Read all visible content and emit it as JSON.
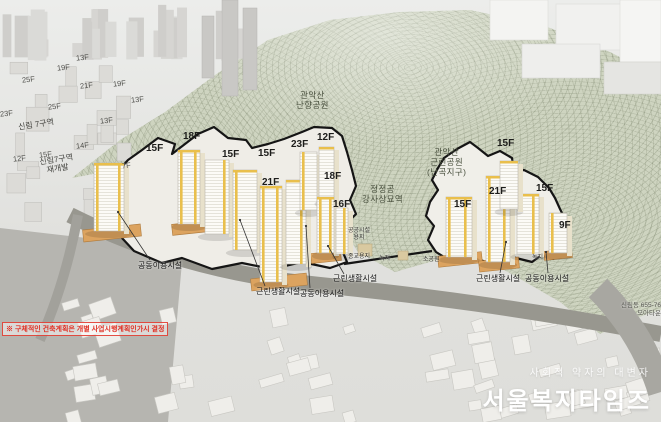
{
  "scene": {
    "disclaimer": "※ 구체적인 건축계획은 개별 사업시행계획인가시 결정",
    "watermark": {
      "slogan": "사회적 약자의 대변자",
      "title": "서울복지타임즈"
    },
    "address": {
      "line1": "신림동 655-76",
      "line2": "모아타운"
    }
  },
  "colors": {
    "accent_yellow": "#e9bf4c",
    "site_outline": "#151515",
    "mountain_green": "#ced4c0",
    "road_gray": "#98978f",
    "podium_orange": "#dca35f",
    "disclaimer_red": "#e03024"
  },
  "labels": {
    "site_floors": [
      {
        "t": "15F",
        "x": 146,
        "y": 143
      },
      {
        "t": "18F",
        "x": 183,
        "y": 131
      },
      {
        "t": "15F",
        "x": 222,
        "y": 149
      },
      {
        "t": "15F",
        "x": 258,
        "y": 148
      },
      {
        "t": "23F",
        "x": 291,
        "y": 139
      },
      {
        "t": "12F",
        "x": 317,
        "y": 132
      },
      {
        "t": "21F",
        "x": 262,
        "y": 177
      },
      {
        "t": "18F",
        "x": 324,
        "y": 171
      },
      {
        "t": "16F",
        "x": 333,
        "y": 199
      },
      {
        "t": "15F",
        "x": 497,
        "y": 138
      },
      {
        "t": "15F",
        "x": 536,
        "y": 183
      },
      {
        "t": "21F",
        "x": 489,
        "y": 186
      },
      {
        "t": "15F",
        "x": 454,
        "y": 199
      },
      {
        "t": "9F",
        "x": 559,
        "y": 220
      }
    ],
    "context_floors": [
      {
        "t": "13F",
        "x": 76,
        "y": 54
      },
      {
        "t": "19F",
        "x": 57,
        "y": 64
      },
      {
        "t": "25F",
        "x": 22,
        "y": 76
      },
      {
        "t": "21F",
        "x": 80,
        "y": 82
      },
      {
        "t": "19F",
        "x": 113,
        "y": 80
      },
      {
        "t": "13F",
        "x": 131,
        "y": 96
      },
      {
        "t": "25F",
        "x": 48,
        "y": 103
      },
      {
        "t": "13F",
        "x": 100,
        "y": 117
      },
      {
        "t": "23F",
        "x": 0,
        "y": 110
      },
      {
        "t": "12F",
        "x": 13,
        "y": 155
      },
      {
        "t": "15F",
        "x": 39,
        "y": 151
      },
      {
        "t": "14F",
        "x": 76,
        "y": 142
      },
      {
        "t": "7F",
        "x": 122,
        "y": 162
      }
    ],
    "areas": [
      {
        "t": "신림 7구역",
        "x": 18,
        "y": 120
      },
      {
        "t": "신림7구역\n재개발",
        "x": 40,
        "y": 155
      }
    ],
    "parks": [
      {
        "t": "관악산\n난향공원",
        "x": 296,
        "y": 91
      },
      {
        "t": "관악산\n근린공원\n(난곡지구)",
        "x": 427,
        "y": 148
      },
      {
        "t": "정정공\n강사상묘역",
        "x": 362,
        "y": 185
      }
    ],
    "landuse": [
      {
        "t": "공공시설\n용지",
        "x": 348,
        "y": 228
      },
      {
        "t": "종교용지",
        "x": 348,
        "y": 254
      },
      {
        "t": "녹지",
        "x": 379,
        "y": 256
      },
      {
        "t": "소공원",
        "x": 423,
        "y": 257
      },
      {
        "t": "녹지",
        "x": 532,
        "y": 255
      }
    ],
    "facilities": [
      {
        "t": "공동이용시설",
        "x": 138,
        "y": 261
      },
      {
        "t": "근린생활시설",
        "x": 256,
        "y": 287
      },
      {
        "t": "공동이용시설",
        "x": 300,
        "y": 289
      },
      {
        "t": "근린생활시설",
        "x": 333,
        "y": 274
      },
      {
        "t": "근린생활시설",
        "x": 476,
        "y": 274
      },
      {
        "t": "공동이용시설",
        "x": 525,
        "y": 274
      }
    ]
  }
}
